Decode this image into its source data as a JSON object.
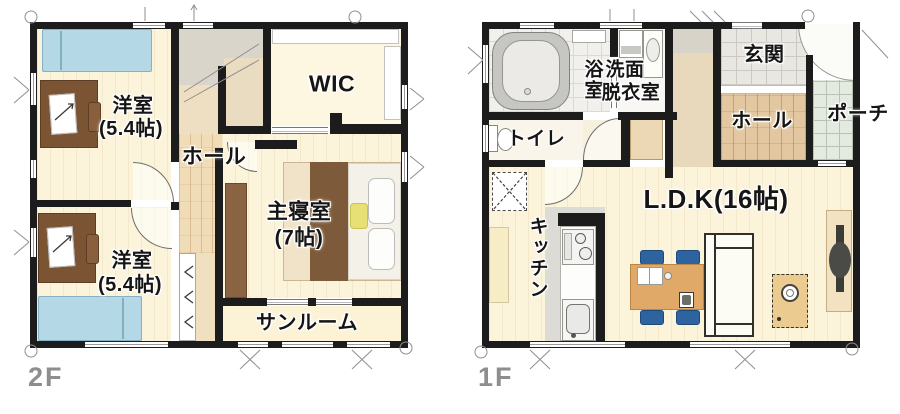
{
  "plan_2f": {
    "floor_label": "2F",
    "bedroom_top_name": "洋室",
    "bedroom_top_size": "(5.4帖)",
    "wic_label": "WIC",
    "hall_label": "ホール",
    "master_name": "主寝室",
    "master_size": "(7帖)",
    "bedroom_bottom_name": "洋室",
    "bedroom_bottom_size": "(5.4帖)",
    "sunroom_label": "サンルーム"
  },
  "plan_1f": {
    "floor_label": "1F",
    "bath_label": "浴室",
    "washroom_label_line1": "洗面",
    "washroom_label_line2": "脱衣室",
    "toilet_label": "トイレ",
    "entrance_label": "玄関",
    "hall_label": "ホール",
    "porch_label": "ポーチ",
    "kitchen_label": "キッチン",
    "ldk_label": "L.D.K(16帖)"
  },
  "palette": {
    "wall": "#1c1c1c",
    "floor_cream": "#fbf3da",
    "hall_wood": "#e2c7a0",
    "bed_blue": "#b5d8e7",
    "desk_brown": "#7a5433",
    "chair_blue": "#2d639f",
    "table_wood": "#e0a967",
    "rug_tan": "#eccb90",
    "porch_green": "#e3eadf",
    "entry_tile_grey": "#e9e7e1",
    "stair_grey": "#d9d5cb",
    "floor_label_grey": "#8e8e8e"
  }
}
